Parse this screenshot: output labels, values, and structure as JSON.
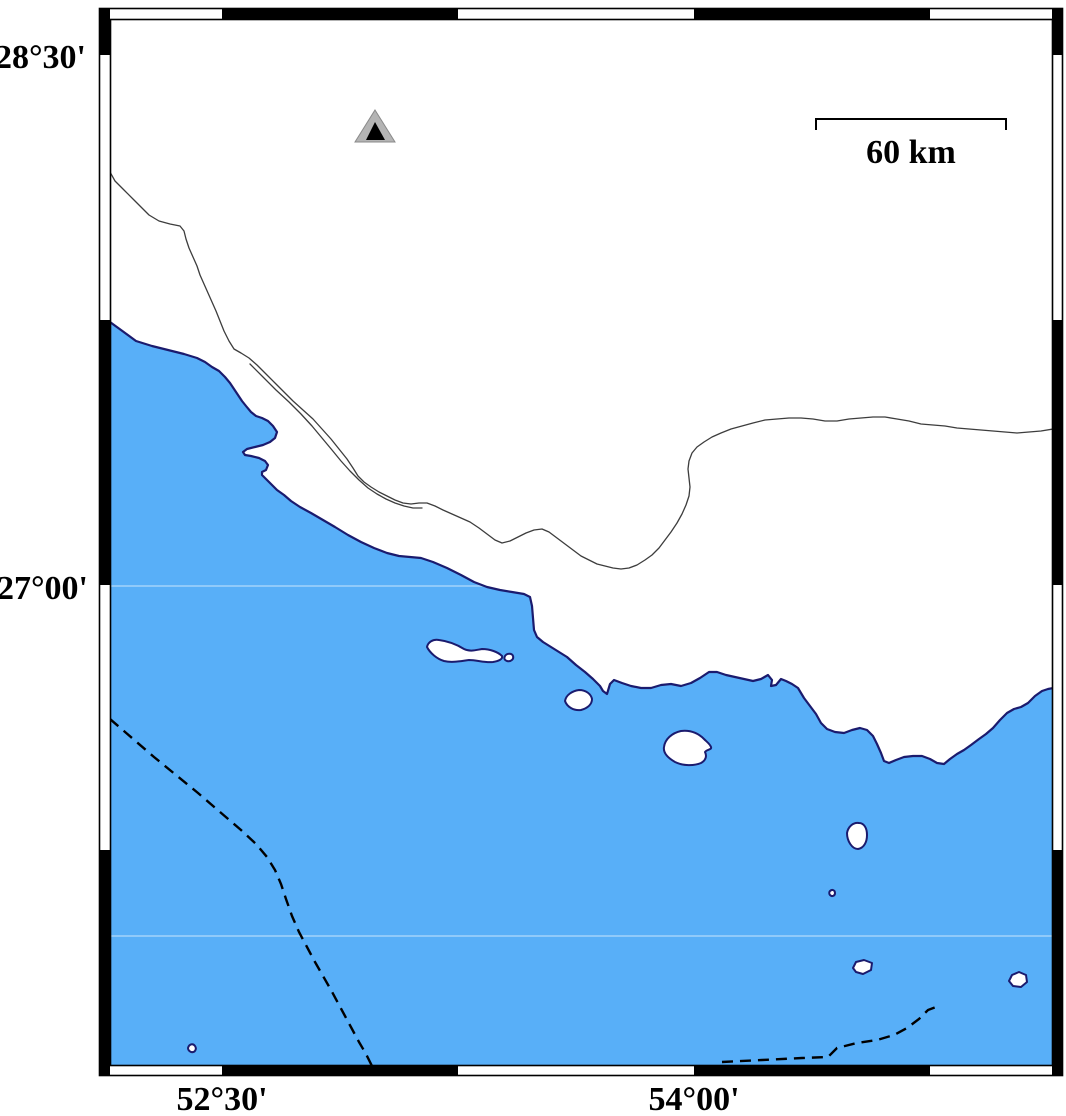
{
  "labels": {
    "lat_top": "28°30'",
    "lat_mid": "27°00'",
    "lon_left": "52°30'",
    "lon_right": "54°00'"
  },
  "scale_bar": {
    "label": "60 km",
    "length_km": 60
  },
  "marker": {
    "symbol": "nested-triangle-station"
  },
  "colors": {
    "sea": "#58AFF8",
    "land": "#FFFFFF",
    "coast": "#1B1B6E",
    "frame": "#000000",
    "border_line": "#3D3D3D",
    "boundary": "#000000",
    "marker_outer": "#B4B4B4",
    "marker_inner": "#000000"
  },
  "geometry": {
    "sea": "M110,322 L121,330 L136,341 L152,346 L168,350 L184,354 L197,358 L205,362 L212,367 L219,371 L225,377 L230,383 L234,389 L238,395 L242,401 L246,406 L251,412 L256,416 L262,418 L268,421 L273,426 L277,432 L275,438 L270,442 L263,445 L255,447 L247,449 L243,452 L245,455 L251,456 L259,458 L265,461 L268,465 L266,470 L262,472 L262,475 L266,479 L271,484 L277,490 L284,495 L291,501 L300,507 L311,513 L323,520 L335,527 L348,535 L361,542 L374,548 L387,553 L399,556 L410,557 L421,558 L433,562 L447,568 L461,575 L474,582 L487,587 L500,590 L512,592 L524,594 L530,597 L532,606 L533,618 L534,630 L537,637 L543,642 L551,647 L559,652 L567,657 L576,665 L585,672 L593,679 L600,686 L603,691 L607,694 L610,684 L614,680 L622,683 L631,686 L641,688 L651,688 L661,685 L671,684 L681,686 L691,683 L700,678 L709,672 L717,672 L726,675 L735,677 L744,679 L753,681 L761,679 L768,675 L772,680 L771,686 L776,685 L781,679 L786,681 L792,684 L798,688 L804,698 L810,706 L816,714 L821,723 L827,729 L835,732 L844,733 L852,730 L860,728 L867,730 L873,736 L877,744 L881,753 L884,761 L889,763 L896,760 L904,757 L913,756 L922,756 L930,759 L937,763 L944,764 L950,759 L957,754 L964,750 L971,745 L979,739 L986,734 L993,728 L1000,720 L1007,713 L1014,709 L1021,707 L1028,703 L1035,696 L1042,691 L1048,689 L1053,688 L1053,1066 L110,1066 Z",
    "coastline": "M110,322 L121,330 L136,341 L152,346 L168,350 L184,354 L197,358 L205,362 L212,367 L219,371 L225,377 L230,383 L234,389 L238,395 L242,401 L246,406 L251,412 L256,416 L262,418 L268,421 L273,426 L277,432 L275,438 L270,442 L263,445 L255,447 L247,449 L243,452 L245,455 L251,456 L259,458 L265,461 L268,465 L266,470 L262,472 L262,475 L266,479 L271,484 L277,490 L284,495 L291,501 L300,507 L311,513 L323,520 L335,527 L348,535 L361,542 L374,548 L387,553 L399,556 L410,557 L421,558 L433,562 L447,568 L461,575 L474,582 L487,587 L500,590 L512,592 L524,594 L530,597 L532,606 L533,618 L534,630 L537,637 L543,642 L551,647 L559,652 L567,657 L576,665 L585,672 L593,679 L600,686 L603,691 L607,694 L610,684 L614,680 L622,683 L631,686 L641,688 L651,688 L661,685 L671,684 L681,686 L691,683 L700,678 L709,672 L717,672 L726,675 L735,677 L744,679 L753,681 L761,679 L768,675 L772,680 L771,686 L776,685 L781,679 L786,681 L792,684 L798,688 L804,698 L810,706 L816,714 L821,723 L827,729 L835,732 L844,733 L852,730 L860,728 L867,730 L873,736 L877,744 L881,753 L884,761 L889,763 L896,760 L904,757 L913,756 L922,756 L930,759 L937,763 L944,764 L950,759 L957,754 L964,750 L971,745 L979,739 L986,734 L993,728 L1000,720 L1007,713 L1014,709 L1021,707 L1028,703 L1035,696 L1042,691 L1048,689 L1053,688",
    "islands": [
      "M427,647 C428,642 433,639 439,640 C447,641 456,644 464,649 C470,652 476,650 482,649 C490,649 498,652 502,656 C503,659 499,661 493,662 C485,663 477,660 469,660 C461,661 452,663 444,661 C437,659 430,653 427,647 Z",
      "M505,656 C507,653 512,653 513,656 C514,659 511,662 507,661 C504,660 504,658 505,656 Z",
      "M565,701 C566,695 572,691 579,690 C586,690 591,694 592,699 C592,704 588,708 581,710 C574,711 567,707 565,701 Z",
      "M664,747 C665,739 672,733 681,731 C690,730 698,733 704,739 C707,742 710,744 711,747 C712,750 707,749 705,752 C707,756 706,760 701,763 C694,766 683,766 675,762 C668,758 663,753 664,747 Z",
      "M847,833 C848,827 853,822 859,823 C864,823 867,828 867,835 C867,842 864,848 858,849 C852,849 847,841 847,833 Z",
      "M830,891 C832,889 835,890 835,893 C835,896 832,897 830,895 C829,894 829,892 830,891 Z",
      "M853,968 L856,962 L864,960 L872,963 L871,970 L863,974 L856,972 Z",
      "M1009,981 L1012,975 L1019,972 L1026,975 L1027,982 L1021,987 L1013,986 Z",
      "M188,1048 C189,1044 193,1043 195,1046 C197,1049 195,1053 191,1052 C189,1051 188,1050 188,1048 Z"
    ],
    "borders": [
      "M110,172 L115,181 L124,190 L133,199 L141,207 L149,215 L159,221 L170,224 L180,226 L184,231 L186,239 L189,248 L193,257 L197,266 L200,275 L204,284 L208,293 L212,302 L216,311 L220,321 L224,331 L229,341 L234,349 L241,353 L249,358 L257,365 L266,374 L275,383 L284,392 L293,401 L303,410 L313,419 L322,429 L331,439 L339,449 L347,459 L353,468 L358,476 L364,482 L371,487 L379,492 L387,496 L395,500 L403,503 L411,504 L419,503 L427,503 L435,506 L443,510 L452,514 L461,518 L470,522 L479,528 L487,534 L495,540 L502,543 L510,541 L518,537 L526,533 L534,530 L542,529 L549,532 L557,538 L565,544 L573,550 L581,556 L589,560 L597,564 L605,566 L613,568 L621,569 L629,568 L637,565 L645,560 L652,555 L659,548 L665,540 L671,532 L677,523 L682,514 L686,505 L689,496 L690,487 L689,478 L688,469 L689,461 L692,453 L697,447 L704,442 L712,437 L721,433 L731,429 L742,426 L753,423 L765,420 L777,419 L789,418 L801,418 L813,419 L825,421 L837,421 L849,419 L861,418 L873,417 L885,417 L897,419 L909,421 L921,424 L933,425 L945,426 L957,428 L969,429 L981,430 L993,431 L1005,432 L1017,433 L1029,432 L1041,431 L1053,429",
      "M250,364 L263,377 L276,390 L289,402 L301,414 L312,426 L322,438 L332,450 L341,461 L350,471 L359,480 L368,488 L377,494 L386,499 L395,503 L404,506 L413,508 L422,508"
    ],
    "maritime_boundaries": [
      "M110,719 L132,738 L154,757 L176,775 L198,793 L220,812 L241,830 L256,844 L267,857 L275,870 L281,884 L286,899 L292,916 L299,932 L307,947 L315,962 L323,976 L331,990 L338,1003 L345,1016 L352,1029 L359,1042 L366,1054 L372,1066",
      "M722,1062 L762,1060 L802,1058 L828,1057 L837,1048 L857,1043 L877,1040 L894,1035 L907,1028 L919,1019 L928,1010 L936,1007"
    ],
    "gridlines": [
      "M110,586 L487,586",
      "M110,936 L1053,936"
    ],
    "scale_bar_path": "M816,130 L816,119 L1006,119 L1006,130",
    "triangle_outer": "M375,110 L395,142 L355,142 Z",
    "triangle_inner": "M375,122 L385,140 L366,140 Z"
  }
}
